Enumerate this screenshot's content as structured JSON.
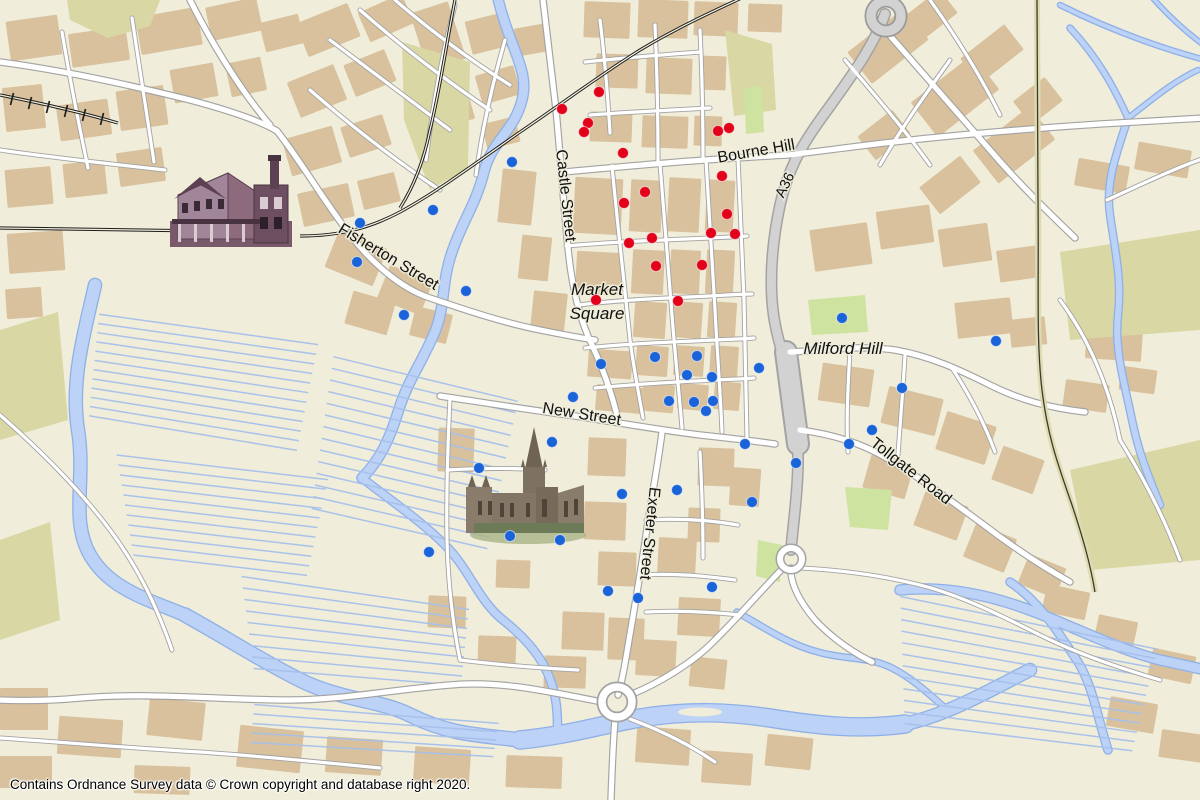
{
  "map": {
    "attribution": "Contains Ordnance Survey data © Crown copyright and database right 2020.",
    "colors": {
      "background": "#f0edda",
      "building": "#d8c19c",
      "road_fill": "#ffffff",
      "road_casing": "#a3a3a3",
      "trunk_fill": "#d2d2d2",
      "water": "#bcd2f6",
      "water_edge": "#8fb0e8",
      "green": "#d9d8a4",
      "railway": "#1c1c1c",
      "label": "#111111",
      "red_marker": "#e2001a",
      "blue_marker": "#1a63d8"
    },
    "labels": [
      {
        "id": "castle-street",
        "text": "Castle Street",
        "x": 561,
        "y": 196,
        "rot": 84,
        "kind": "street"
      },
      {
        "id": "fisherton-street",
        "text": "Fisherton Street",
        "x": 386,
        "y": 261,
        "rot": 31,
        "kind": "street"
      },
      {
        "id": "bourne-hill",
        "text": "Bourne Hill",
        "x": 757,
        "y": 156,
        "rot": -10,
        "kind": "street"
      },
      {
        "id": "a36",
        "text": "A36",
        "x": 789,
        "y": 187,
        "rot": -64,
        "kind": "route"
      },
      {
        "id": "market-square-1",
        "text": "Market",
        "x": 597,
        "y": 295,
        "rot": 0,
        "kind": "place"
      },
      {
        "id": "market-square-2",
        "text": "Square",
        "x": 597,
        "y": 319,
        "rot": 0,
        "kind": "place"
      },
      {
        "id": "milford-hill",
        "text": "Milford Hill",
        "x": 843,
        "y": 354,
        "rot": 0,
        "kind": "place"
      },
      {
        "id": "new-street",
        "text": "New Street",
        "x": 581,
        "y": 419,
        "rot": 9,
        "kind": "street"
      },
      {
        "id": "exeter-street",
        "text": "Exeter Street",
        "x": 645,
        "y": 533,
        "rot": 96,
        "kind": "street"
      },
      {
        "id": "tollgate-road",
        "text": "Tollgate Road",
        "x": 908,
        "y": 475,
        "rot": 38,
        "kind": "street"
      }
    ],
    "markers": {
      "red": [
        [
          599,
          92
        ],
        [
          562,
          109
        ],
        [
          588,
          123
        ],
        [
          584,
          132
        ],
        [
          623,
          153
        ],
        [
          718,
          131
        ],
        [
          729,
          128
        ],
        [
          722,
          176
        ],
        [
          645,
          192
        ],
        [
          624,
          203
        ],
        [
          727,
          214
        ],
        [
          711,
          233
        ],
        [
          735,
          234
        ],
        [
          652,
          238
        ],
        [
          629,
          243
        ],
        [
          656,
          266
        ],
        [
          702,
          265
        ],
        [
          596,
          300
        ],
        [
          678,
          301
        ]
      ],
      "blue": [
        [
          512,
          162
        ],
        [
          433,
          210
        ],
        [
          360,
          223
        ],
        [
          357,
          262
        ],
        [
          466,
          291
        ],
        [
          404,
          315
        ],
        [
          601,
          364
        ],
        [
          655,
          357
        ],
        [
          697,
          356
        ],
        [
          687,
          375
        ],
        [
          712,
          377
        ],
        [
          759,
          368
        ],
        [
          573,
          397
        ],
        [
          669,
          401
        ],
        [
          694,
          402
        ],
        [
          713,
          401
        ],
        [
          706,
          411
        ],
        [
          842,
          318
        ],
        [
          996,
          341
        ],
        [
          902,
          388
        ],
        [
          872,
          430
        ],
        [
          849,
          444
        ],
        [
          796,
          463
        ],
        [
          745,
          444
        ],
        [
          552,
          442
        ],
        [
          479,
          468
        ],
        [
          622,
          494
        ],
        [
          677,
          490
        ],
        [
          752,
          502
        ],
        [
          510,
          536
        ],
        [
          560,
          540
        ],
        [
          429,
          552
        ],
        [
          608,
          591
        ],
        [
          638,
          598
        ],
        [
          712,
          587
        ]
      ]
    },
    "landmarks": [
      {
        "id": "railway-station",
        "name": "Salisbury railway station illustration"
      },
      {
        "id": "cathedral",
        "name": "Salisbury Cathedral illustration"
      }
    ]
  }
}
